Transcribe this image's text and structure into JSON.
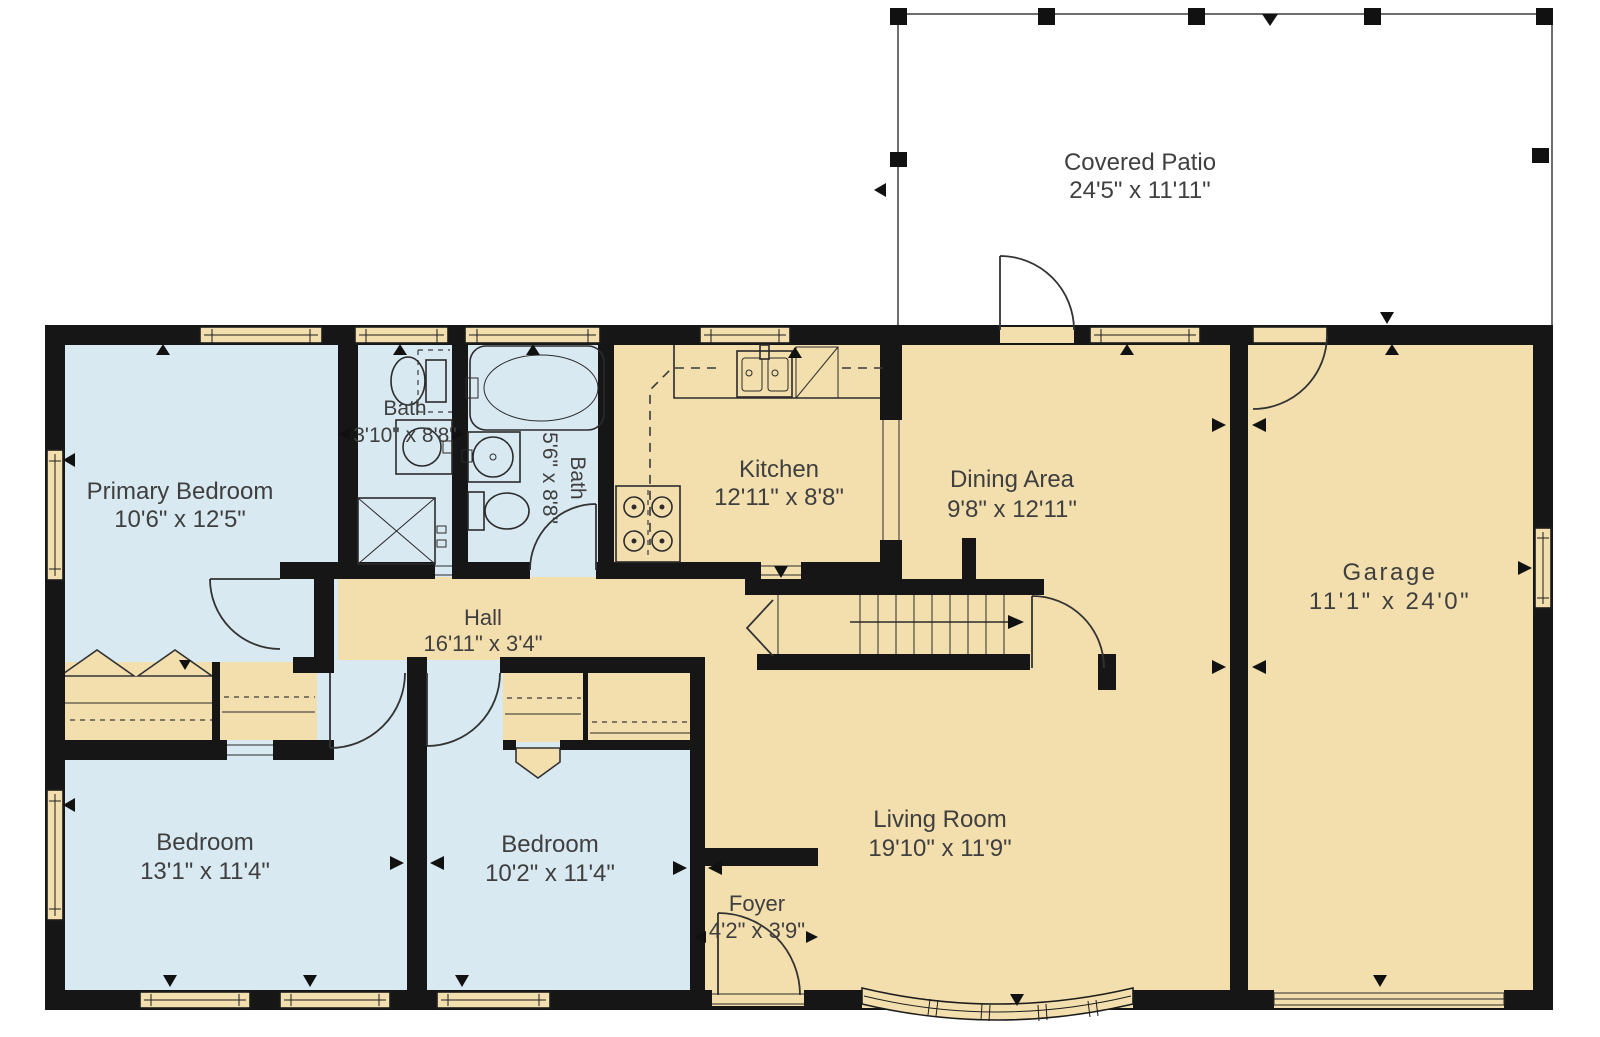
{
  "patio": {
    "label": "Covered Patio",
    "dims": "24'5\" x 11'11\""
  },
  "rooms": {
    "primary_bedroom": {
      "label": "Primary Bedroom",
      "dims": "10'6\" x 12'5\""
    },
    "bath_small": {
      "label": "Bath",
      "dims": "3'10\" x 8'8\""
    },
    "bath_hall": {
      "label": "Bath",
      "dims": "5'6\" x 8'8\""
    },
    "kitchen": {
      "label": "Kitchen",
      "dims": "12'11\" x 8'8\""
    },
    "dining_area": {
      "label": "Dining Area",
      "dims": "9'8\" x 12'11\""
    },
    "garage": {
      "label": "Garage",
      "dims": "11'1\" x 24'0\""
    },
    "hall": {
      "label": "Hall",
      "dims": "16'11\" x 3'4\""
    },
    "living_room": {
      "label": "Living Room",
      "dims": "19'10\" x 11'9\""
    },
    "foyer": {
      "label": "Foyer",
      "dims": "4'2\" x 3'9\""
    },
    "bedroom_left": {
      "label": "Bedroom",
      "dims": "13'1\" x 11'4\""
    },
    "bedroom_middle": {
      "label": "Bedroom",
      "dims": "10'2\" x 11'4\""
    }
  },
  "colors": {
    "wall": "#161616",
    "floor_tan": "#f3dfae",
    "floor_blue": "#d9e9f2",
    "patio_white": "#ffffff",
    "label_text": "#3f3f3f"
  }
}
